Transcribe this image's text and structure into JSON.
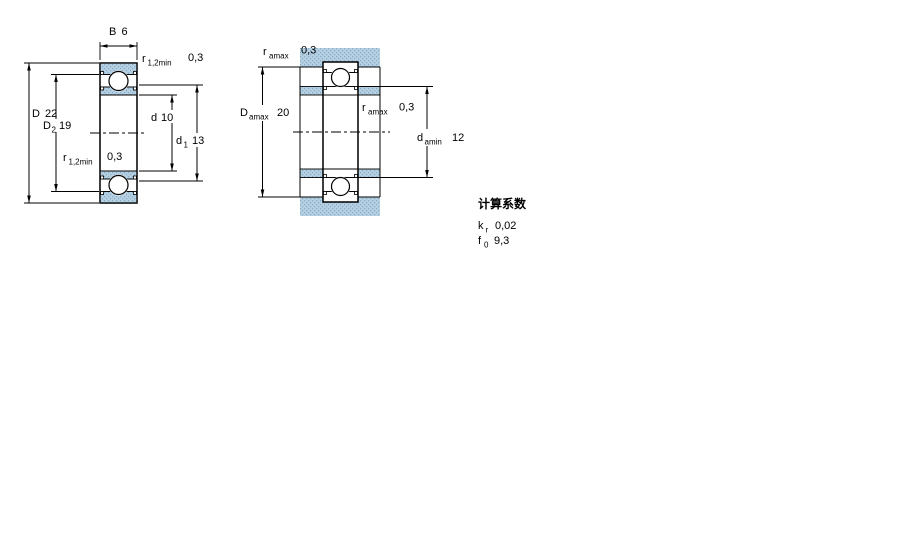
{
  "left_figure": {
    "width_dim": {
      "symbol": "B",
      "value": "6"
    },
    "outer_dia_dim": {
      "symbol": "D",
      "value": "22"
    },
    "d2_dim": {
      "symbol": "D",
      "sub": "2",
      "value": "19"
    },
    "bore_dim": {
      "symbol": "d",
      "value": "10"
    },
    "d1_dim": {
      "symbol": "d",
      "sub": "1",
      "value": "13"
    },
    "fillet_top": {
      "symbol": "r",
      "sub": "1,2min",
      "value": "0,3"
    },
    "fillet_bottom": {
      "symbol": "r",
      "sub": "1,2min",
      "value": "0,3"
    }
  },
  "right_figure": {
    "fillet_top": {
      "symbol": "r",
      "sub": "amax",
      "value": "0,3"
    },
    "housing_abutment_dim": {
      "symbol": "D",
      "sub": "amax",
      "value": "20"
    },
    "fillet_mid": {
      "symbol": "r",
      "sub": "amax",
      "value": "0,3"
    },
    "shaft_abutment_dim": {
      "symbol": "d",
      "sub": "amin",
      "value": "12"
    }
  },
  "calculation_factors": {
    "heading": "计算系数",
    "rows": [
      {
        "symbol": "k",
        "sub": "r",
        "value": "0,02"
      },
      {
        "symbol": "f",
        "sub": "0",
        "value": "9,3"
      }
    ]
  },
  "colors": {
    "ring_fill": "#b5d0e2",
    "ring_dot": "#8aabc6",
    "outline": "#000000",
    "background": "#ffffff"
  }
}
